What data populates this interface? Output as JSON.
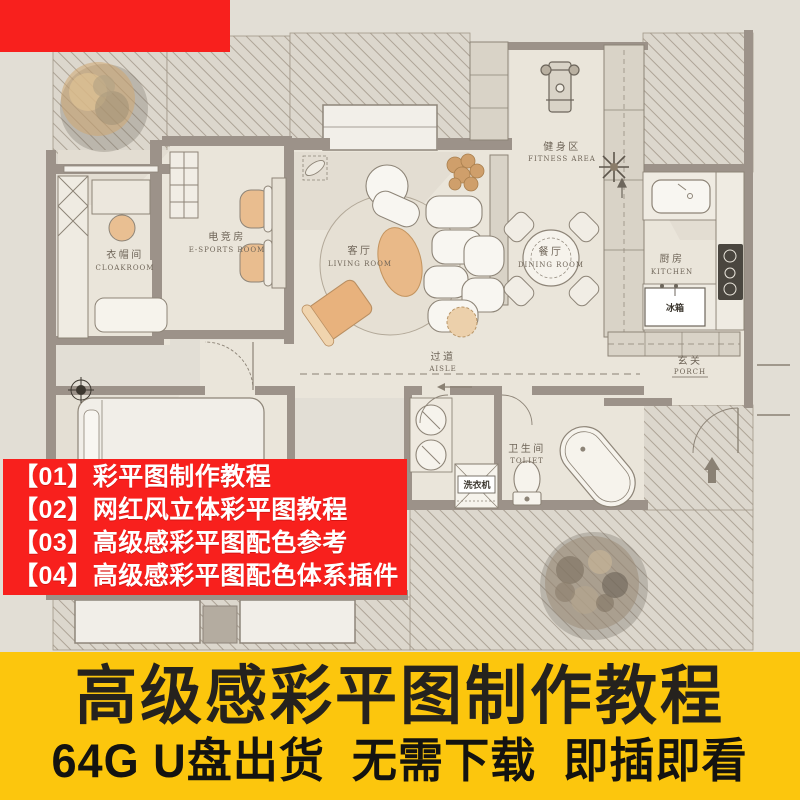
{
  "floorplan": {
    "rooms": {
      "cloakroom": {
        "zh": "衣帽间",
        "en": "CLOAKROOM"
      },
      "esports": {
        "zh": "电竞房",
        "en": "E-SPORTS ROOM"
      },
      "living": {
        "zh": "客厅",
        "en": "LIVING ROOM"
      },
      "dining": {
        "zh": "餐厅",
        "en": "DINING ROOM"
      },
      "fitness": {
        "zh": "健身区",
        "en": "FITNESS AREA"
      },
      "kitchen": {
        "zh": "厨房",
        "en": "KITCHEN"
      },
      "aisle": {
        "zh": "过道",
        "en": "AISLE"
      },
      "porch": {
        "zh": "玄关",
        "en": "PORCH"
      },
      "toilet": {
        "zh": "卫生间",
        "en": "TOLIET"
      }
    },
    "appliances": {
      "fridge": "冰箱",
      "washer": "洗衣机"
    }
  },
  "promo_list": {
    "bg": "#f8201d",
    "items": [
      "【01】彩平图制作教程",
      "【02】网红风立体彩平图教程",
      "【03】高级感彩平图配色参考",
      "【04】高级感彩平图配色体系插件"
    ]
  },
  "banner": {
    "bg": "#fcc60d",
    "title": "高级感彩平图制作教程",
    "subtitle": "64G U盘出货  无需下载  即插即看"
  },
  "colors": {
    "badge_red": "#f8201d",
    "banner_yellow": "#fcc60d",
    "wall": "#9c9289",
    "floor": "#eae5da",
    "accent_orange": "#e9ba8a"
  }
}
